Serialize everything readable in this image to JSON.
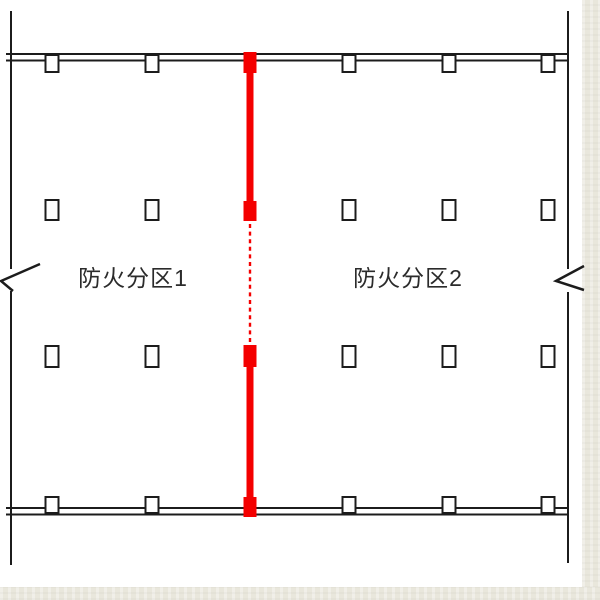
{
  "drawing": {
    "type": "architectural-floor-plan",
    "labels": {
      "zone1": "防火分区1",
      "zone2": "防火分区2"
    },
    "colors": {
      "fire_wall": "#f40000",
      "line": "#1c1c1c",
      "paper": "#ffffff",
      "mat": "#e9e7dc",
      "text": "#2b2b2b"
    }
  }
}
